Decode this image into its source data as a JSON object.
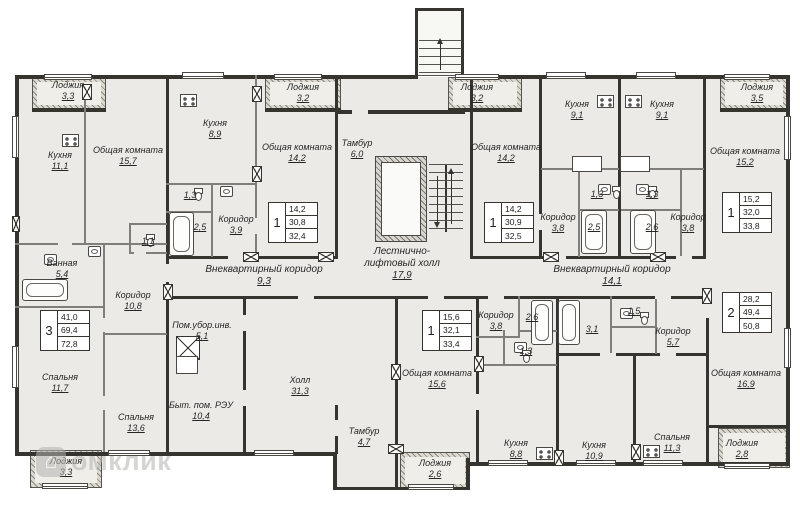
{
  "watermark": {
    "icon": "house-logo",
    "text": "омклик"
  },
  "rooms": {
    "a_loggia_top": {
      "name": "Лоджия",
      "area": "3,3"
    },
    "a_kitchen": {
      "name": "Кухня",
      "area": "11,1"
    },
    "a_living": {
      "name": "Общая комната",
      "area": "15,7"
    },
    "a_wc": {
      "name": "",
      "area": "1,1"
    },
    "a_bath": {
      "name": "Ванная",
      "area": "5,4"
    },
    "a_hall": {
      "name": "Коридор",
      "area": "10,8"
    },
    "a_bed1": {
      "name": "Спальня",
      "area": "11,7"
    },
    "a_bed2": {
      "name": "Спальня",
      "area": "13,6"
    },
    "a_loggia_bottom": {
      "name": "Лоджия",
      "area": "3,3"
    },
    "b_kitchen": {
      "name": "Кухня",
      "area": "8,9"
    },
    "b_loggia": {
      "name": "Лоджия",
      "area": "3,2"
    },
    "b_living": {
      "name": "Общая комната",
      "area": "14,2"
    },
    "b_wc": {
      "name": "",
      "area": "1,3"
    },
    "b_bath": {
      "name": "",
      "area": "2,5"
    },
    "b_hall": {
      "name": "Коридор",
      "area": "3,9"
    },
    "tambur_main": {
      "name": "Тамбур",
      "area": "6,0"
    },
    "stair_hall": {
      "name": "Лестнично-лифтовый холл",
      "area": "17,9"
    },
    "corridor_left": {
      "name": "Внеквартирный коридор",
      "area": "9,3"
    },
    "cleaning": {
      "name": "Пом.убор.инв.",
      "area": "5,1"
    },
    "reu": {
      "name": "Быт. пом. РЭУ",
      "area": "10,4"
    },
    "hall_big": {
      "name": "Холл",
      "area": "31,3"
    },
    "tambur_small": {
      "name": "Тамбур",
      "area": "4,7"
    },
    "c_loggia": {
      "name": "Лоджия",
      "area": "3,2"
    },
    "c_living": {
      "name": "Общая комната",
      "area": "14,2"
    },
    "c_kitchen": {
      "name": "Кухня",
      "area": "9,1"
    },
    "c_wc": {
      "name": "",
      "area": "1,3"
    },
    "c_bath": {
      "name": "",
      "area": "2,5"
    },
    "c_hall": {
      "name": "Коридор",
      "area": "3,8"
    },
    "d_kitchen": {
      "name": "Кухня",
      "area": "9,1"
    },
    "d_loggia": {
      "name": "Лоджия",
      "area": "3,5"
    },
    "d_living": {
      "name": "Общая комната",
      "area": "15,2"
    },
    "d_wc": {
      "name": "",
      "area": "1,3"
    },
    "d_bath": {
      "name": "",
      "area": "2,6"
    },
    "d_hall": {
      "name": "Коридор",
      "area": "3,8"
    },
    "corridor_right": {
      "name": "Внеквартирный коридор",
      "area": "14,1"
    },
    "e_living": {
      "name": "Общая комната",
      "area": "15,6"
    },
    "e_hall": {
      "name": "Коридор",
      "area": "3,8"
    },
    "e_bath": {
      "name": "",
      "area": "2,6"
    },
    "e_wc": {
      "name": "",
      "area": "1,3"
    },
    "e_kitchen": {
      "name": "Кухня",
      "area": "8,8"
    },
    "e_loggia": {
      "name": "Лоджия",
      "area": "2,6"
    },
    "f_bath": {
      "name": "",
      "area": "3,1"
    },
    "f_wc": {
      "name": "",
      "area": "1,5"
    },
    "f_hall": {
      "name": "Коридор",
      "area": "5,7"
    },
    "f_living": {
      "name": "Общая комната",
      "area": "16,9"
    },
    "f_kitchen": {
      "name": "Кухня",
      "area": "10,9"
    },
    "f_bed": {
      "name": "Спальня",
      "area": "11,3"
    },
    "f_loggia": {
      "name": "Лоджия",
      "area": "2,8"
    }
  },
  "apartments": {
    "apt3": {
      "number": "3",
      "living_area": "41,0",
      "total_area": "69,4",
      "total_with_loggia": "72,8"
    },
    "aptB": {
      "number": "1",
      "living_area": "14,2",
      "total_area": "30,8",
      "total_with_loggia": "32,4"
    },
    "aptC": {
      "number": "1",
      "living_area": "14,2",
      "total_area": "30,9",
      "total_with_loggia": "32,5"
    },
    "aptD": {
      "number": "1",
      "living_area": "15,2",
      "total_area": "32,0",
      "total_with_loggia": "33,8"
    },
    "aptE": {
      "number": "1",
      "living_area": "15,6",
      "total_area": "32,1",
      "total_with_loggia": "33,4"
    },
    "aptF": {
      "number": "2",
      "living_area": "28,2",
      "total_area": "49,4",
      "total_with_loggia": "50,8"
    }
  }
}
